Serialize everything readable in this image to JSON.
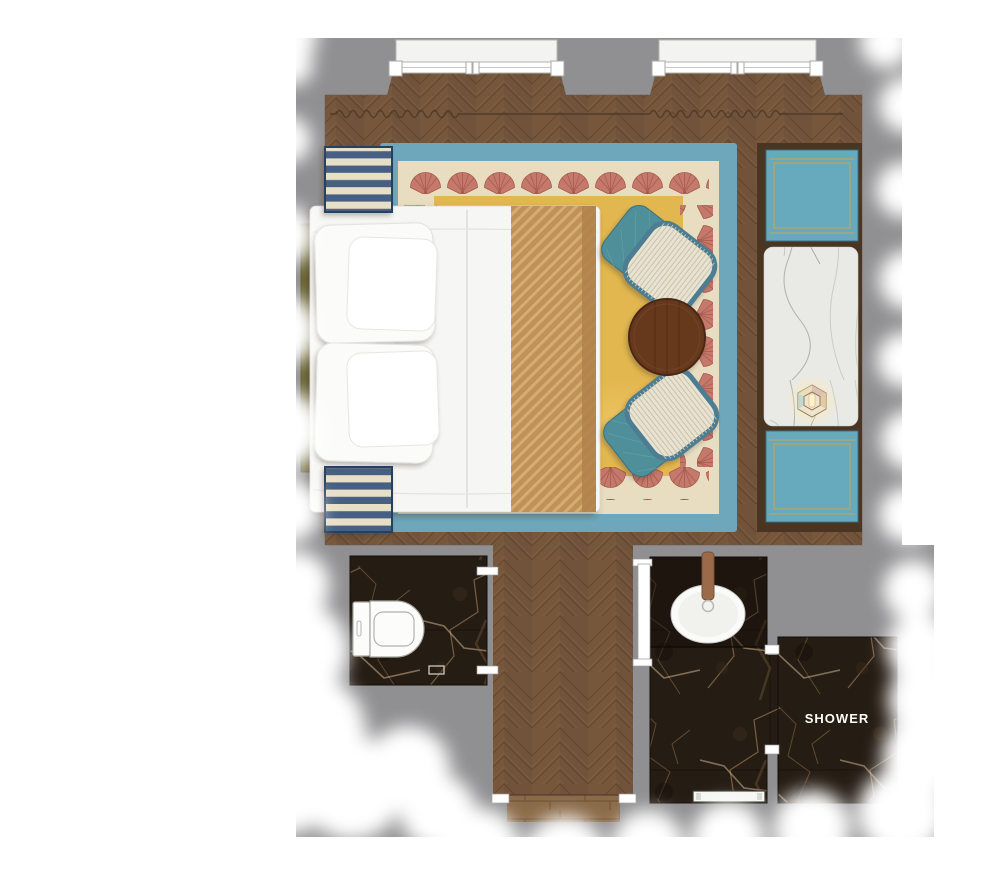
{
  "floorplan": {
    "title": "hotel-guest-room-floor-plan-top-view",
    "labels": {
      "shower": "SHOWER"
    },
    "colors": {
      "wall": "#8f8f91",
      "wood": "#77573c",
      "threshold_wood": "#8a6a48",
      "rug_blue": "#6ea7bc",
      "rug_cream": "#e9ddc1",
      "rug_yellow": "#e3b74f",
      "shell_pink": "#c5796b",
      "shell_rib": "#a3594d",
      "bench_navy": "#475f82",
      "bench_cream": "#e8dfc7",
      "headboard_olive": "#6e6a39",
      "bed_white": "#f6f6f4",
      "runner_tan": "#c09158",
      "chair_teal": "#4f8f99",
      "chair_seat": "#e8e3d0",
      "table_wood": "#66391f",
      "console_wood": "#4a3422",
      "ottoman_teal": "#68aabd",
      "ottoman_gold": "#c9a44e",
      "marble_white": "#e9e9e6",
      "marble_dark": "#251c13",
      "marble_vein": "#c49b6e",
      "fixture_white": "#fbfbf9",
      "lantern_glow": "#ffe9b0"
    },
    "rooms": [
      {
        "name": "bedroom",
        "floor": "herringbone-wood"
      },
      {
        "name": "wc",
        "floor": "dark-marble"
      },
      {
        "name": "corridor",
        "floor": "herringbone-wood"
      },
      {
        "name": "bathroom-vanity",
        "floor": "dark-marble"
      },
      {
        "name": "shower-room",
        "floor": "dark-marble",
        "label": "SHOWER"
      }
    ],
    "furniture": [
      "double-bed",
      "pillows",
      "bed-runner",
      "headboard",
      "striped-bench-top",
      "striped-bench-bottom",
      "wicker-armchair-top",
      "wicker-armchair-bottom",
      "round-side-table",
      "luggage-ottoman-top",
      "luggage-ottoman-bottom",
      "marble-console",
      "lantern",
      "toilet",
      "oval-sink",
      "shower-bench",
      "window-left",
      "window-right",
      "curtain-left",
      "curtain-right"
    ]
  }
}
